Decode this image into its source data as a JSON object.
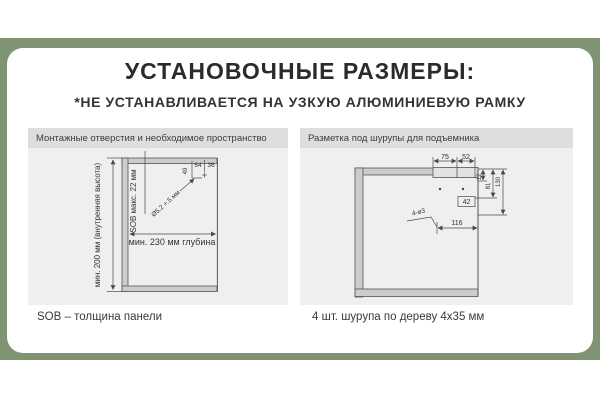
{
  "page": {
    "title": "УСТАНОВОЧНЫЕ РАЗМЕРЫ:",
    "subtitle": "*НЕ УСТАНАВЛИВАЕТСЯ НА УЗКУЮ АЛЮМИНИЕВУЮ РАМКУ"
  },
  "colors": {
    "accent_green": "#7e9472",
    "panel_header": "#dedede",
    "panel_body": "#efefef",
    "wall_fill": "#cccccc",
    "line": "#4a4a4a"
  },
  "left_panel": {
    "header": "Монтажные отверстия и необходимое пространство",
    "caption": "SOB – толщина панели",
    "dims": {
      "inner_height": "мин. 200 мм (внутренняя высота)",
      "sob_thickness": "SOB макс. 22 мм",
      "depth": "мин. 230 мм глубина",
      "hole_diameter": "Ø5.2 +.5 мм",
      "d49": "49",
      "d64": "64",
      "d36": "36"
    }
  },
  "right_panel": {
    "header": "Разметка под шурупы для подъемника",
    "caption": "4 шт. шурупа по дереву 4х35 мм",
    "dims": {
      "d75": "75",
      "d52": "52",
      "d12": "12",
      "d81": "81",
      "d130": "130",
      "d42": "42",
      "d116": "116",
      "holes": "4-ø3"
    }
  }
}
